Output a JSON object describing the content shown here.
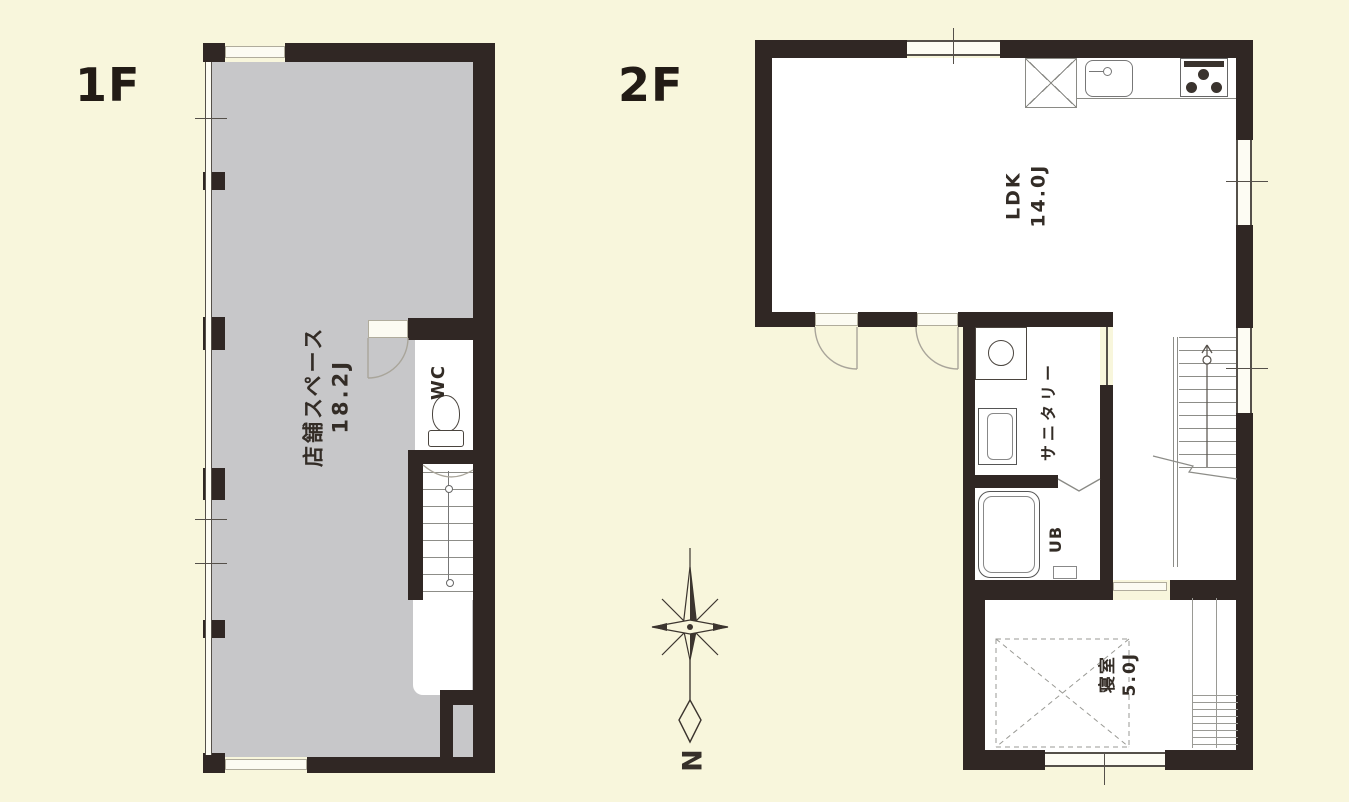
{
  "title": "間取り図 1F / 2F",
  "colors": {
    "background": "#f8f6dc",
    "wall": "#302724",
    "shop_fill": "#c7c7c9",
    "line": "#55504a",
    "text": "#332c26"
  },
  "floor1": {
    "label": "1F",
    "shop_name": "店舗スペース",
    "shop_size": "18.2J",
    "wc_label": "WC"
  },
  "floor2": {
    "label": "2F",
    "ldk_name": "LDK",
    "ldk_size": "14.0J",
    "sanitary_label": "サニタリー",
    "bath_label": "UB",
    "bedroom_name": "寝室",
    "bedroom_size": "5.0J"
  },
  "compass": {
    "north_label": "N"
  }
}
